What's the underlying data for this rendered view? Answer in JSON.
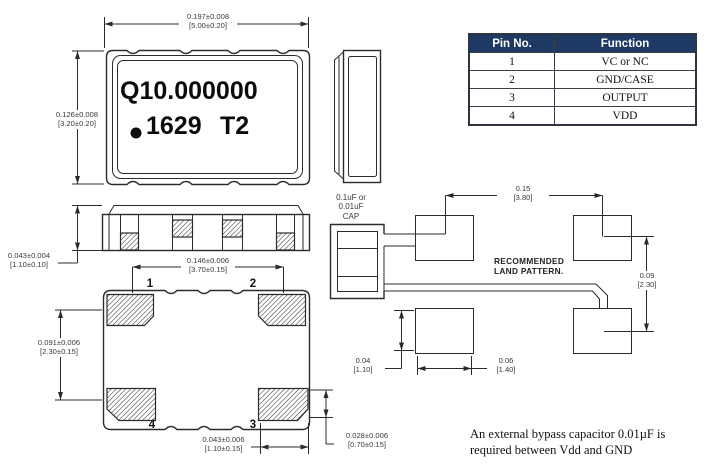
{
  "colors": {
    "line": "#2b2b2b",
    "table_header_bg": "#1e3a64",
    "table_header_text": "#ffffff"
  },
  "package_marking": {
    "line1": "Q10.000000",
    "line2_number": "1629",
    "line2_code": "T2"
  },
  "pin_numbers": {
    "pin1": "1",
    "pin2": "2",
    "pin3": "3",
    "pin4": "4"
  },
  "dimensions": {
    "body_width": {
      "inch": "0.197±0.008",
      "mm": "[5.00±0.20]"
    },
    "body_height": {
      "inch": "0.126±0.008",
      "mm": "[3.20±0.20]"
    },
    "side_height": {
      "inch": "0.043±0.004",
      "mm": "[1.10±0.10]"
    },
    "pad_pitch": {
      "inch": "0.146±0.006",
      "mm": "[3.70±0.15]"
    },
    "row_pitch": {
      "inch": "0.091±0.006",
      "mm": "[2.30±0.15]"
    },
    "pad_width": {
      "inch": "0.043±0.006",
      "mm": "[1.10±0.15]"
    },
    "pad_height": {
      "inch": "0.028±0.006",
      "mm": "[0.70±0.15]"
    },
    "land_width": {
      "inch": "0.15",
      "mm": "[3.80]"
    },
    "land_row": {
      "inch": "0.09",
      "mm": "[2.30]"
    },
    "land_pad_h": {
      "inch": "0.04",
      "mm": "[1.10]"
    },
    "land_pad_w": {
      "inch": "0.06",
      "mm": "[1.40]"
    }
  },
  "pin_table": {
    "header": {
      "pin": "Pin No.",
      "function": "Function"
    },
    "rows": [
      {
        "pin": "1",
        "function": "VC or NC"
      },
      {
        "pin": "2",
        "function": "GND/CASE"
      },
      {
        "pin": "3",
        "function": "OUTPUT"
      },
      {
        "pin": "4",
        "function": "VDD"
      }
    ]
  },
  "land_pattern": {
    "cap_label_lines": [
      "0.1uF or",
      "0.01uF",
      "CAP"
    ],
    "title_lines": [
      "RECOMMENDED",
      "LAND PATTERN."
    ]
  },
  "note_lines": [
    "An external bypass capacitor 0.01µF is",
    "required between Vdd and GND"
  ]
}
